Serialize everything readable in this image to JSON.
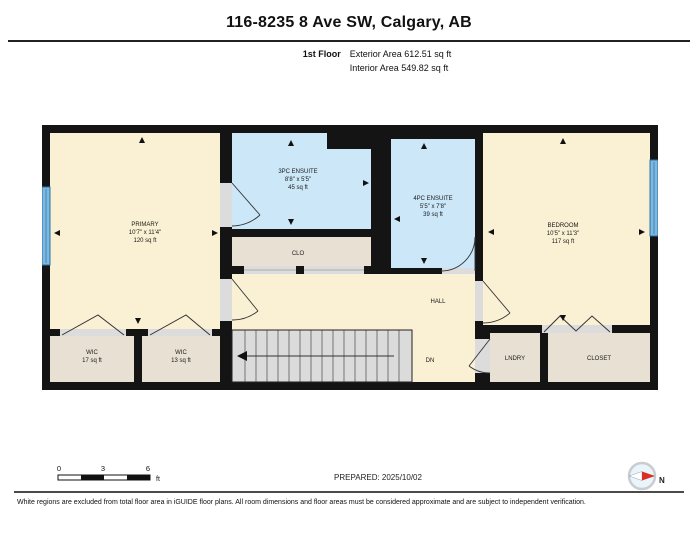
{
  "header": {
    "title": "116-8235 8 Ave SW, Calgary, AB",
    "floor_label": "1st Floor",
    "exterior_area": "Exterior Area 612.51 sq ft",
    "interior_area": "Interior Area 549.82 sq ft"
  },
  "floor_plan": {
    "rooms": {
      "primary": {
        "name": "PRIMARY",
        "dims": "10'7\" x 11'4\"",
        "area": "120 sq ft"
      },
      "ensuite_3pc": {
        "name": "3PC ENSUITE",
        "dims": "8'8\" x 5'5\"",
        "area": "45 sq ft"
      },
      "ensuite_4pc": {
        "name": "4PC ENSUITE",
        "dims": "5'5\" x 7'8\"",
        "area": "39 sq ft"
      },
      "bedroom": {
        "name": "BEDROOM",
        "dims": "10'5\" x 11'3\"",
        "area": "117 sq ft"
      },
      "clo": {
        "name": "CLO"
      },
      "hall": {
        "name": "HALL"
      },
      "stairs": {
        "label": "DN"
      },
      "wic_1": {
        "name": "WIC",
        "area": "17 sq ft"
      },
      "wic_2": {
        "name": "WIC",
        "area": "13 sq ft"
      },
      "laundry": {
        "name": "LNDRY"
      },
      "closet": {
        "name": "CLOSET"
      }
    }
  },
  "scale_bar": {
    "tick_0": "0",
    "tick_3": "3",
    "tick_6": "6",
    "unit": "ft"
  },
  "footer": {
    "prepared": "PREPARED: 2025/10/02",
    "compass_label": "N",
    "disclaimer": "White regions are excluded from total floor area in iGUIDE floor plans. All room dimensions and floor areas must be considered approximate and are subject to independent verification."
  },
  "colors": {
    "wall": "#141414",
    "room_living": "#FAF0D4",
    "room_bath": "#CBE7F8",
    "room_storage": "#E8E0D2",
    "stairs": "#DBDBDB",
    "window": "#7CB9E2",
    "window_frame": "#2F6F9F",
    "compass_red": "#D83025"
  }
}
